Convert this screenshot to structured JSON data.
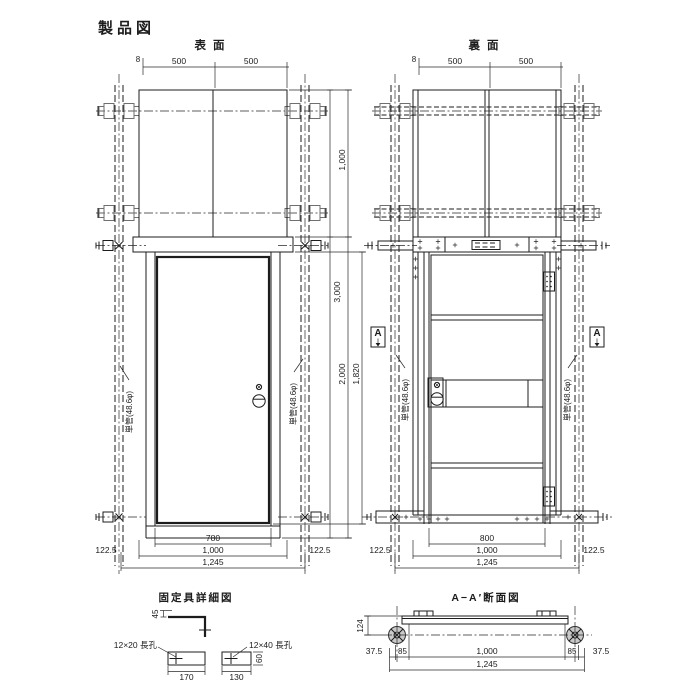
{
  "title": "製品図",
  "front": {
    "label": "表面",
    "dim_top_offset": "8",
    "dim_top_left": "500",
    "dim_top_right": "500",
    "dim_upper": "1,000",
    "dim_overall_h": "3,000",
    "dim_lower": "2,000",
    "dim_door_h": "1,820",
    "dim_opening": "780",
    "dim_span": "1,000",
    "dim_width": "1,245",
    "dim_side_left": "122.5",
    "dim_side_right": "122.5",
    "pipe_left": "単管(48.6φ)",
    "pipe_right": "単管(48.6φ)"
  },
  "back": {
    "label": "裏面",
    "dim_top_offset": "8",
    "dim_top_left": "500",
    "dim_top_right": "500",
    "dim_opening": "800",
    "dim_span": "1,000",
    "dim_width": "1,245",
    "dim_side_left": "122.5",
    "dim_side_right": "122.5",
    "pipe_left": "単管(48.6φ)",
    "pipe_right": "単管(48.6φ)",
    "marker_left": "A",
    "marker_right": "A"
  },
  "fixture": {
    "title": "固定具詳細図",
    "slot_small": "12×20 長孔",
    "slot_large": "12×40 長孔",
    "dim_45": "45",
    "dim_60": "60",
    "dim_170": "170",
    "dim_130": "130"
  },
  "section": {
    "title": "A−A′断面図",
    "dim_height": "124",
    "dim_margin_l": "37.5",
    "dim_offset_l": "85",
    "dim_center": "1,000",
    "dim_offset_r": "85",
    "dim_margin_r": "37.5",
    "dim_width": "1,245"
  }
}
